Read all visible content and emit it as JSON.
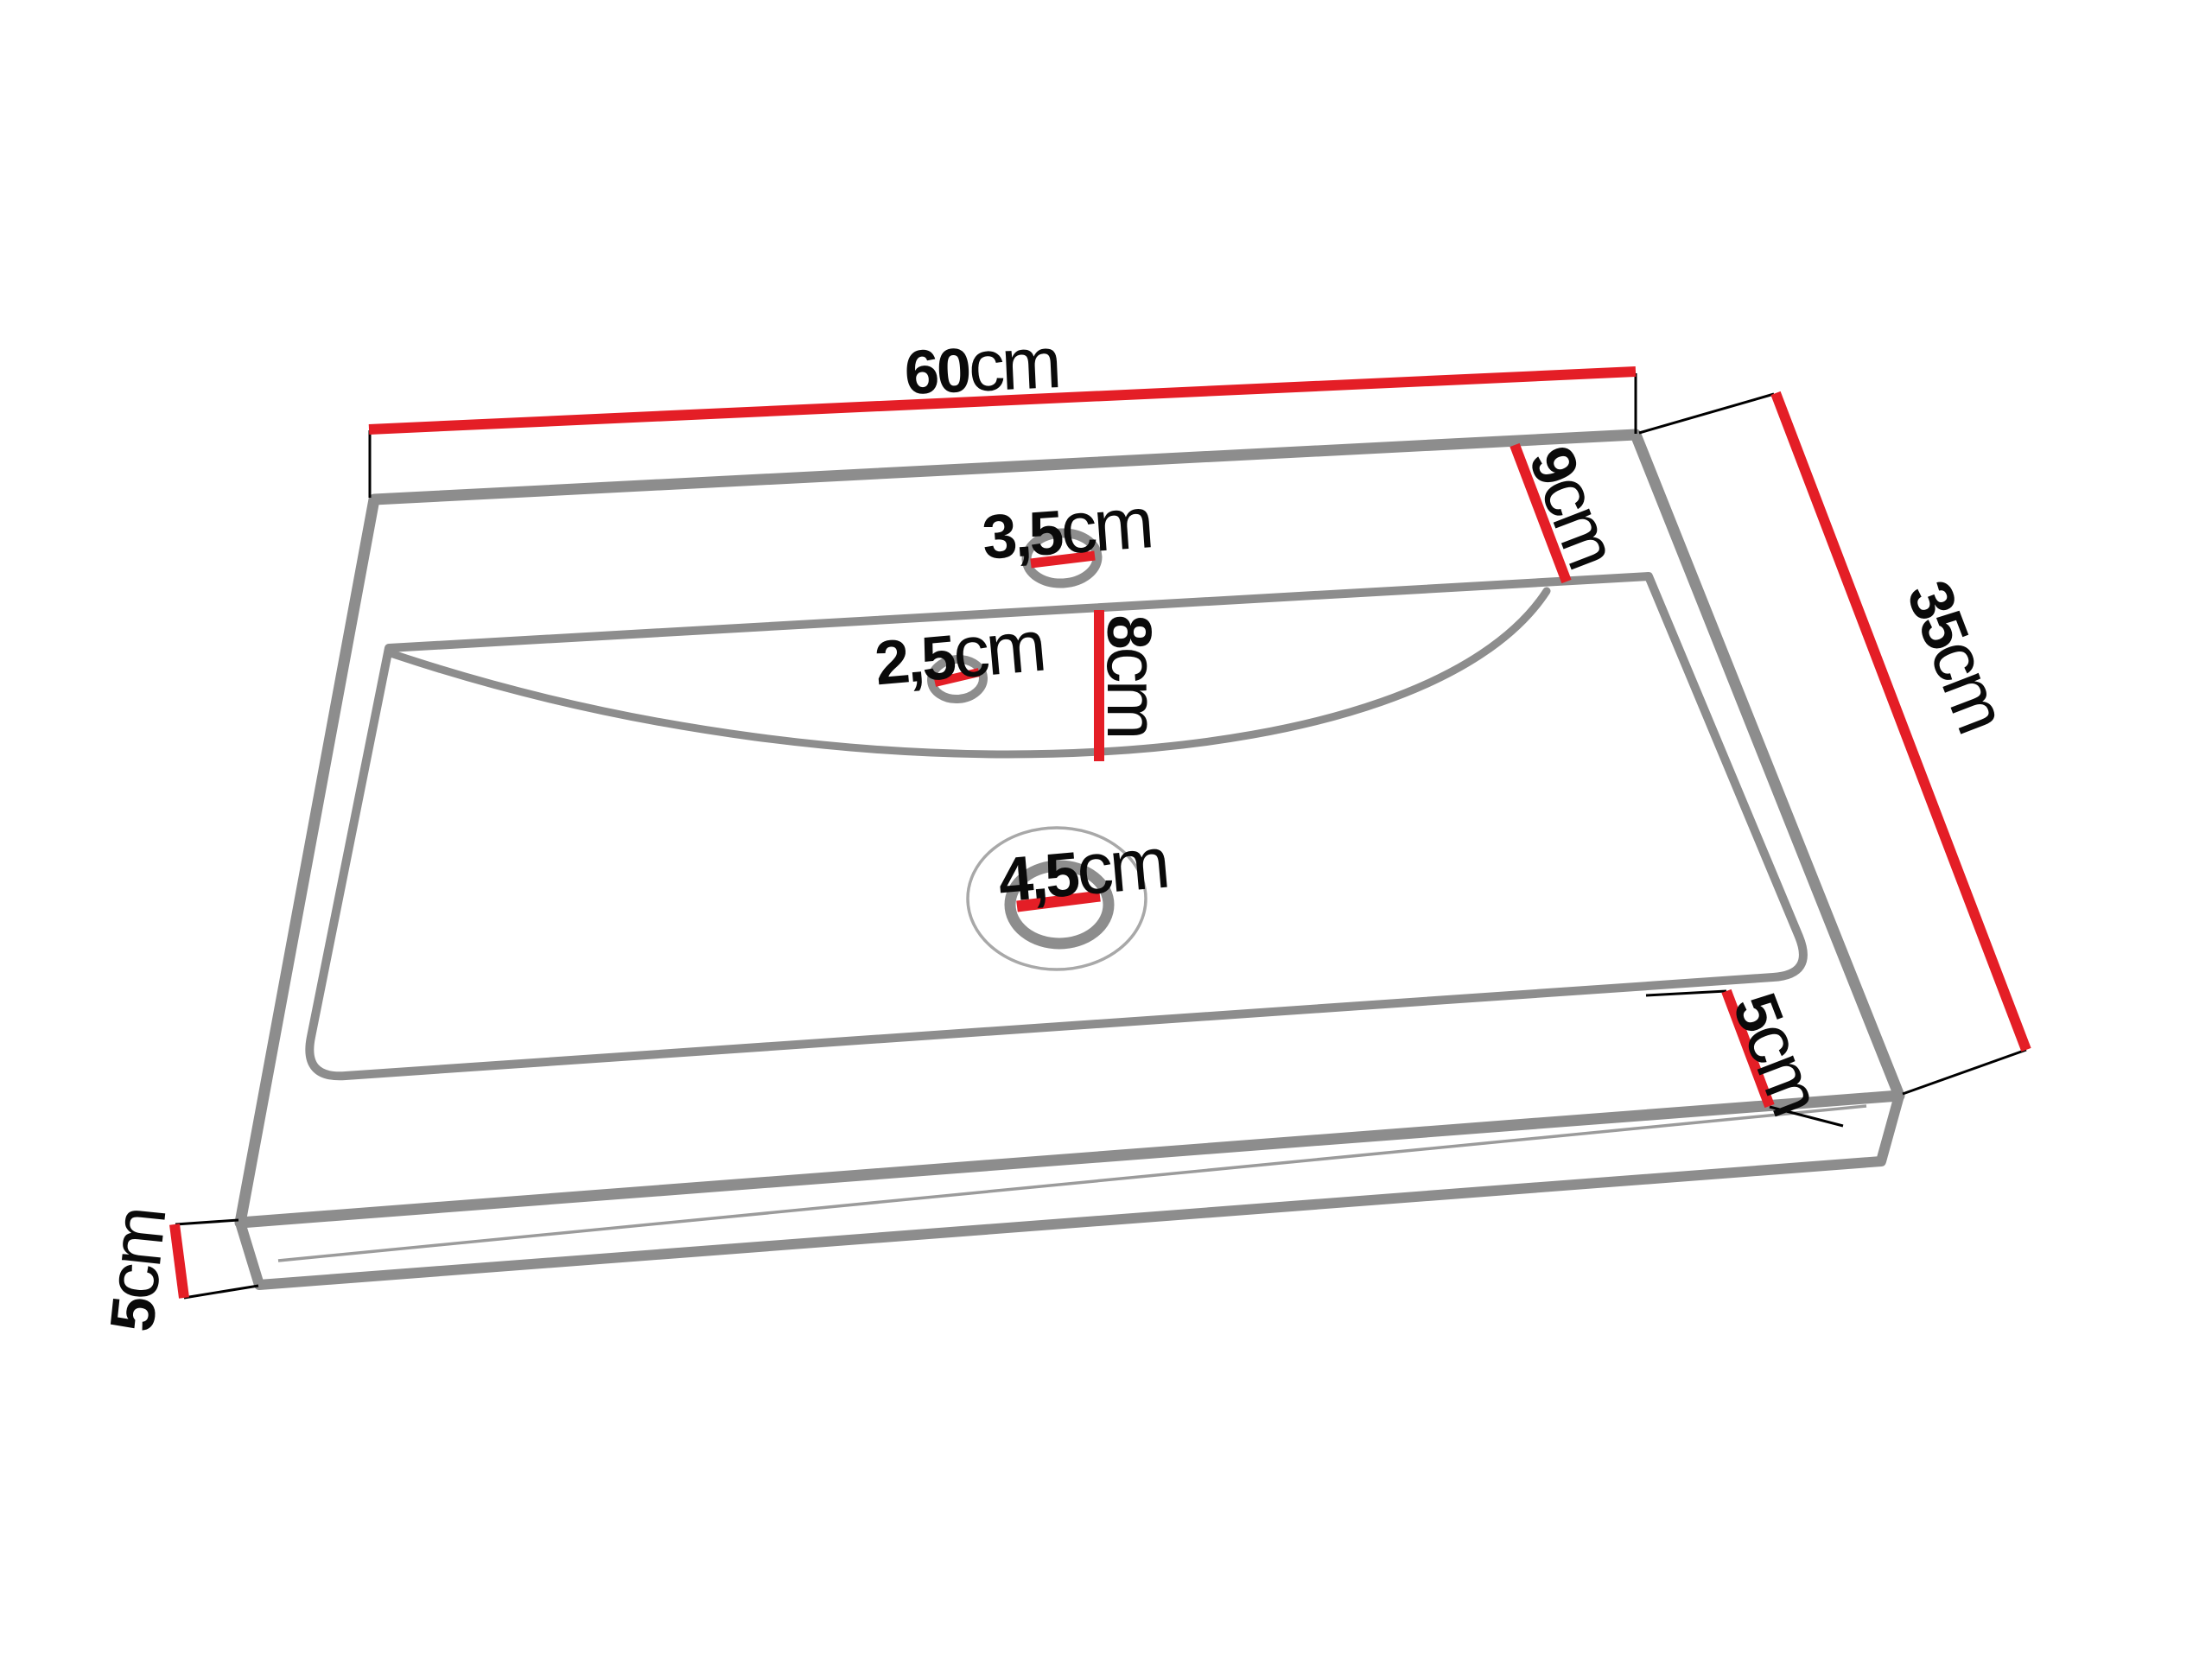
{
  "diagram": {
    "subject": "washbasin-technical-drawing",
    "colors": {
      "dimension_red": "#e41e26",
      "outline_gray": "#8d8d8d",
      "outline_gray_light": "#9b9b9b",
      "text_black": "#0a0a0a",
      "background": "#ffffff"
    },
    "dimensions": {
      "width_top": {
        "value": "60",
        "unit": "cm"
      },
      "depth_right": {
        "value": "35",
        "unit": "cm"
      },
      "rim_back": {
        "value": "9",
        "unit": "cm"
      },
      "bowl_depth": {
        "value": "8",
        "unit": "cm"
      },
      "faucet_hole": {
        "value": "3,5",
        "unit": "cm"
      },
      "overflow_hole": {
        "value": "2,5",
        "unit": "cm"
      },
      "drain_hole": {
        "value": "4,5",
        "unit": "cm"
      },
      "rim_front": {
        "value": "5",
        "unit": "cm"
      },
      "side_height": {
        "value": "5",
        "unit": "cm"
      }
    }
  }
}
